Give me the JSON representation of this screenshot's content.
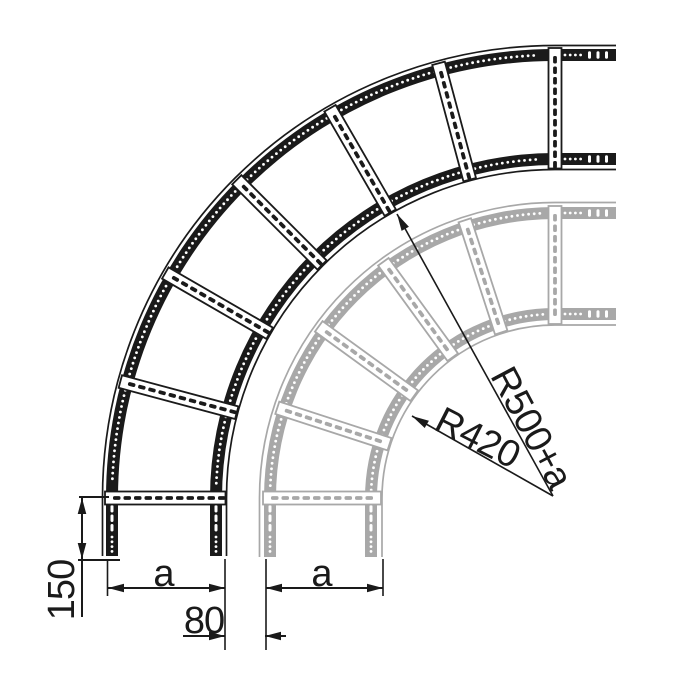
{
  "diagram": {
    "background_color": "#ffffff",
    "ladder_dark_color": "#1a1a1a",
    "ladder_gray_color": "#a8a8a8",
    "dimension_color": "#1a1a1a",
    "dimensions": {
      "radius_large_label": "R500+a",
      "radius_small_label": "R420",
      "leg_height_label": "150",
      "width_dark_label": "a",
      "width_gray_label": "a",
      "gap_label": "80"
    }
  }
}
